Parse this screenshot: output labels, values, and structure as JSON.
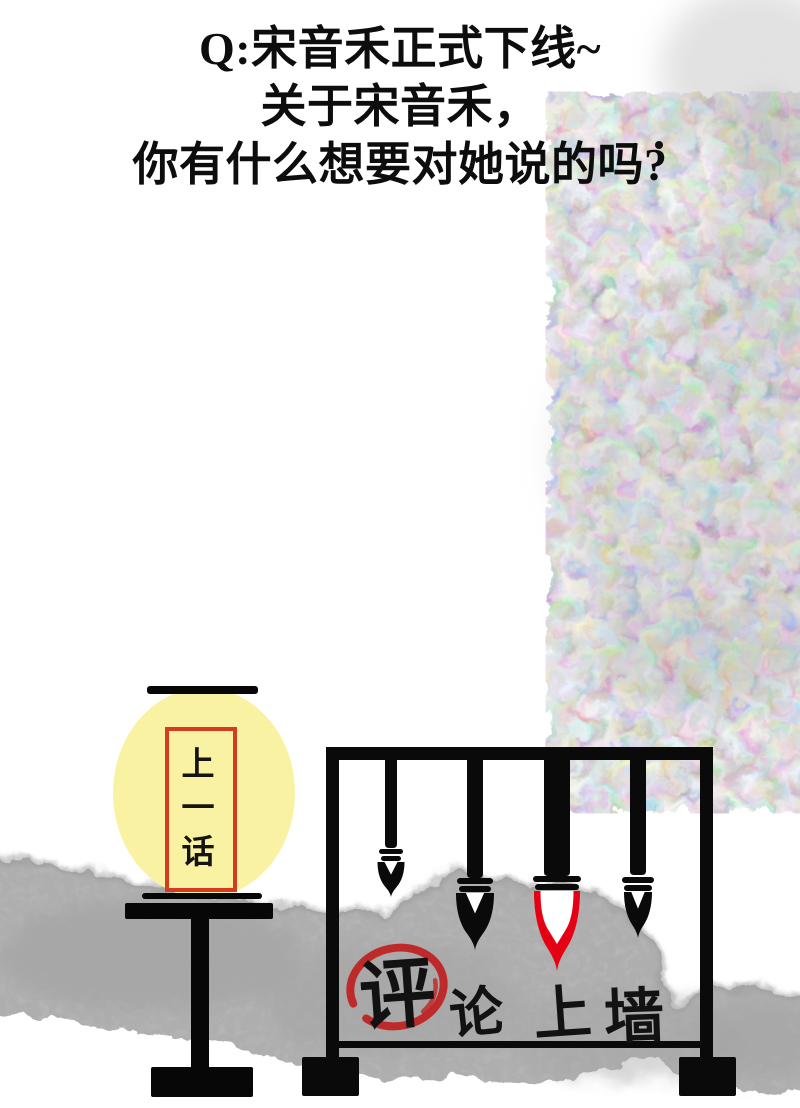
{
  "qa_header": {
    "line1": "Q:宋音禾正式下线~",
    "line2": "关于宋音禾，",
    "line3": "你有什么想要对她说的吗?"
  },
  "prev_chapter": {
    "label": "上一话"
  },
  "comment_wall": {
    "phrase": "评论上墙",
    "chars": [
      "评",
      "论",
      "上",
      "墙"
    ]
  },
  "palette": {
    "lantern_yellow": "#F9F2A2",
    "lantern_frame_red": "#D63A1F",
    "highlight_circle_red": "#BE2A2A",
    "brush_tip_red": "#E60014",
    "ink_band_grey": "#B4B4B4",
    "ink_blob_grey": "#656565",
    "text_black": "#0D0D0D"
  }
}
